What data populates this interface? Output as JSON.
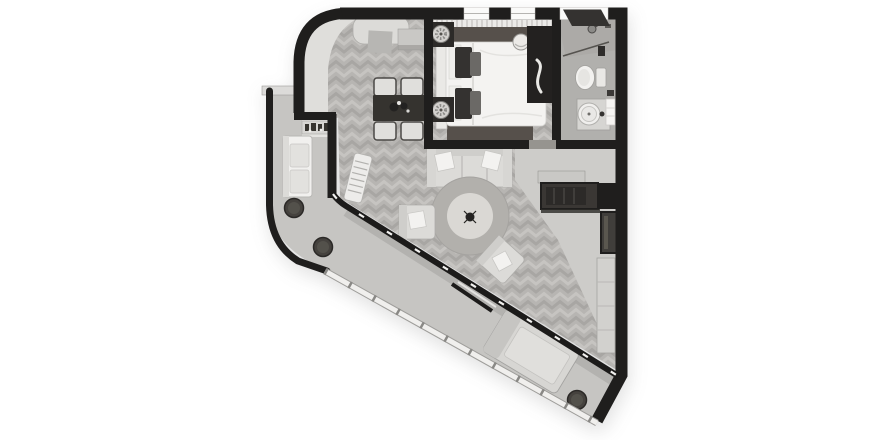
{
  "scene": {
    "kind": "apartment floor plan",
    "view": "top-down 3d render",
    "color_scheme": "grayscale",
    "text_labels": []
  },
  "palette": {
    "bg": "#ffffff",
    "wall": "#1f1e1d",
    "woodBase": "#b7b5b2",
    "woodLight": "#c6c4c1",
    "woodDark": "#a8a6a3",
    "plainFloor": "#d9d8d5",
    "curveBand": "#dfdedb",
    "entryFloor": "#cdccc9",
    "bathFloor": "#b1b0ad",
    "balconyFloor": "#c6c5c2",
    "rugDark": "#56504b",
    "furniture": "#dcdbd8",
    "furnitureLight": "#f3f2f0",
    "furnitureMid": "#c9c8c5",
    "darkItem": "#2c2a28",
    "glass": "#1c1b1a",
    "railing": "#f0efed",
    "pot": "#45423e"
  },
  "rooms": [
    {
      "id": "living-room",
      "floor": "herringbone-wood",
      "furniture": [
        "daybed",
        "side-console",
        "dining-table",
        "dining-chairs-x4",
        "three-seat-sofa",
        "throw-pillows",
        "round-rug",
        "center-decor",
        "armchair-left",
        "armchair-right",
        "radiator"
      ]
    },
    {
      "id": "kitchenette",
      "floor": "plain",
      "furniture": [
        "counter-with-bottles"
      ]
    },
    {
      "id": "bedroom",
      "floor": "herringbone-wood",
      "furniture": [
        "double-bed",
        "headboard",
        "pillows",
        "dark-rug",
        "nightstand-x2",
        "table-lamp-x2",
        "wardrobe-console",
        "decor-sculpture",
        "round-stool",
        "curtains",
        "windows-x2"
      ]
    },
    {
      "id": "bathroom",
      "floor": "plain",
      "furniture": [
        "corner-shower",
        "shower-head",
        "toilet",
        "round-basin-vanity",
        "towels",
        "window-leaf"
      ]
    },
    {
      "id": "entry-hall",
      "floor": "plain",
      "furniture": [
        "recessed-closet",
        "entry-door-recess",
        "wall-wardrobe"
      ]
    },
    {
      "id": "balcony-terrace",
      "floor": "concrete",
      "furniture": [
        "outdoor-sofa",
        "plant-pot-x3",
        "lounge-chaise",
        "glass-facade",
        "railing",
        "parapet-cap"
      ]
    }
  ]
}
